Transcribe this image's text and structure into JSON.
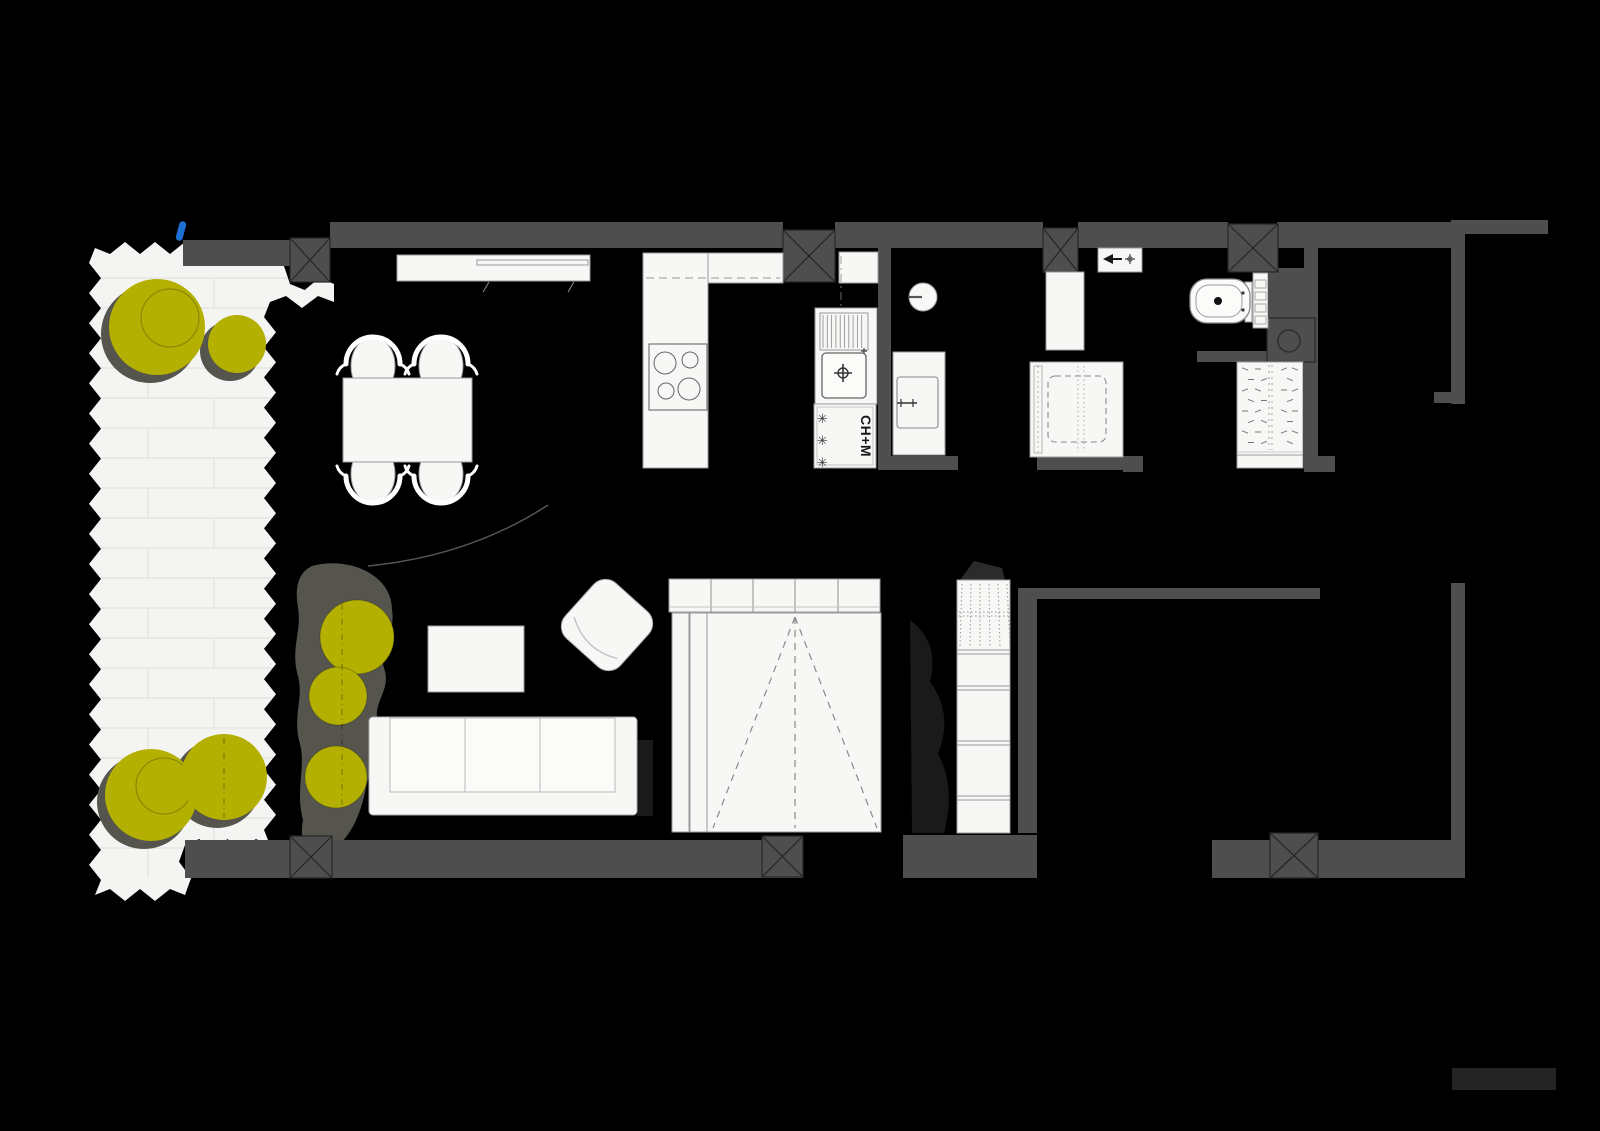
{
  "meta": {
    "type": "architectural-floor-plan",
    "background": "#000000"
  },
  "palette": {
    "wall": "#4e4e4e",
    "fixture_fill": "#f7f7f5",
    "terrace_fill": "#f4f4f2",
    "paving_line": "#dcdcda",
    "foliage": "#b3b001",
    "foliage_shadow": "#55544d",
    "entry_marker": "#1e6fd2",
    "scale_bar": "#242424"
  },
  "labels": {
    "appliance_stack": "CH+M",
    "frost_symbol": "✳"
  }
}
